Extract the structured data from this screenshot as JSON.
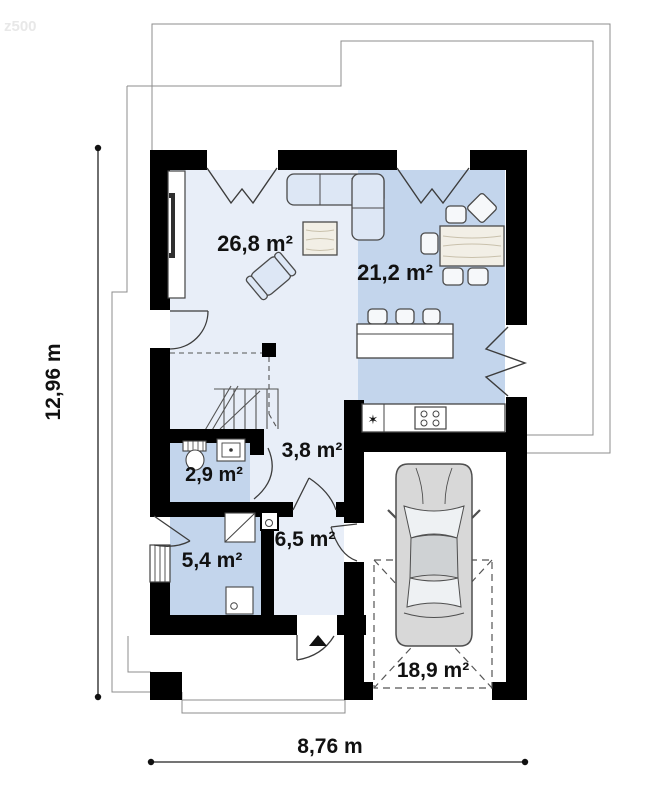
{
  "watermark": "z500",
  "plan": {
    "dimensions": {
      "height": "12,96 m",
      "width": "8,76 m"
    },
    "rooms": [
      {
        "id": "living",
        "area_label": "26,8 m²"
      },
      {
        "id": "kitchen_dining",
        "area_label": "21,2 m²"
      },
      {
        "id": "wc",
        "area_label": "2,9 m²"
      },
      {
        "id": "hall",
        "area_label": "3,8 m²"
      },
      {
        "id": "utility",
        "area_label": "5,4 m²"
      },
      {
        "id": "entry_hall",
        "area_label": "6,5 m²"
      },
      {
        "id": "garage",
        "area_label": "18,9 m²"
      }
    ]
  },
  "colors": {
    "wall": "#000000",
    "room_light": "#e8eef8",
    "room_dark": "#c3d5ec",
    "furniture": "#dde7f5",
    "wood": "#f2efe6",
    "car_body": "#d8d8d8",
    "text": "#111111"
  }
}
